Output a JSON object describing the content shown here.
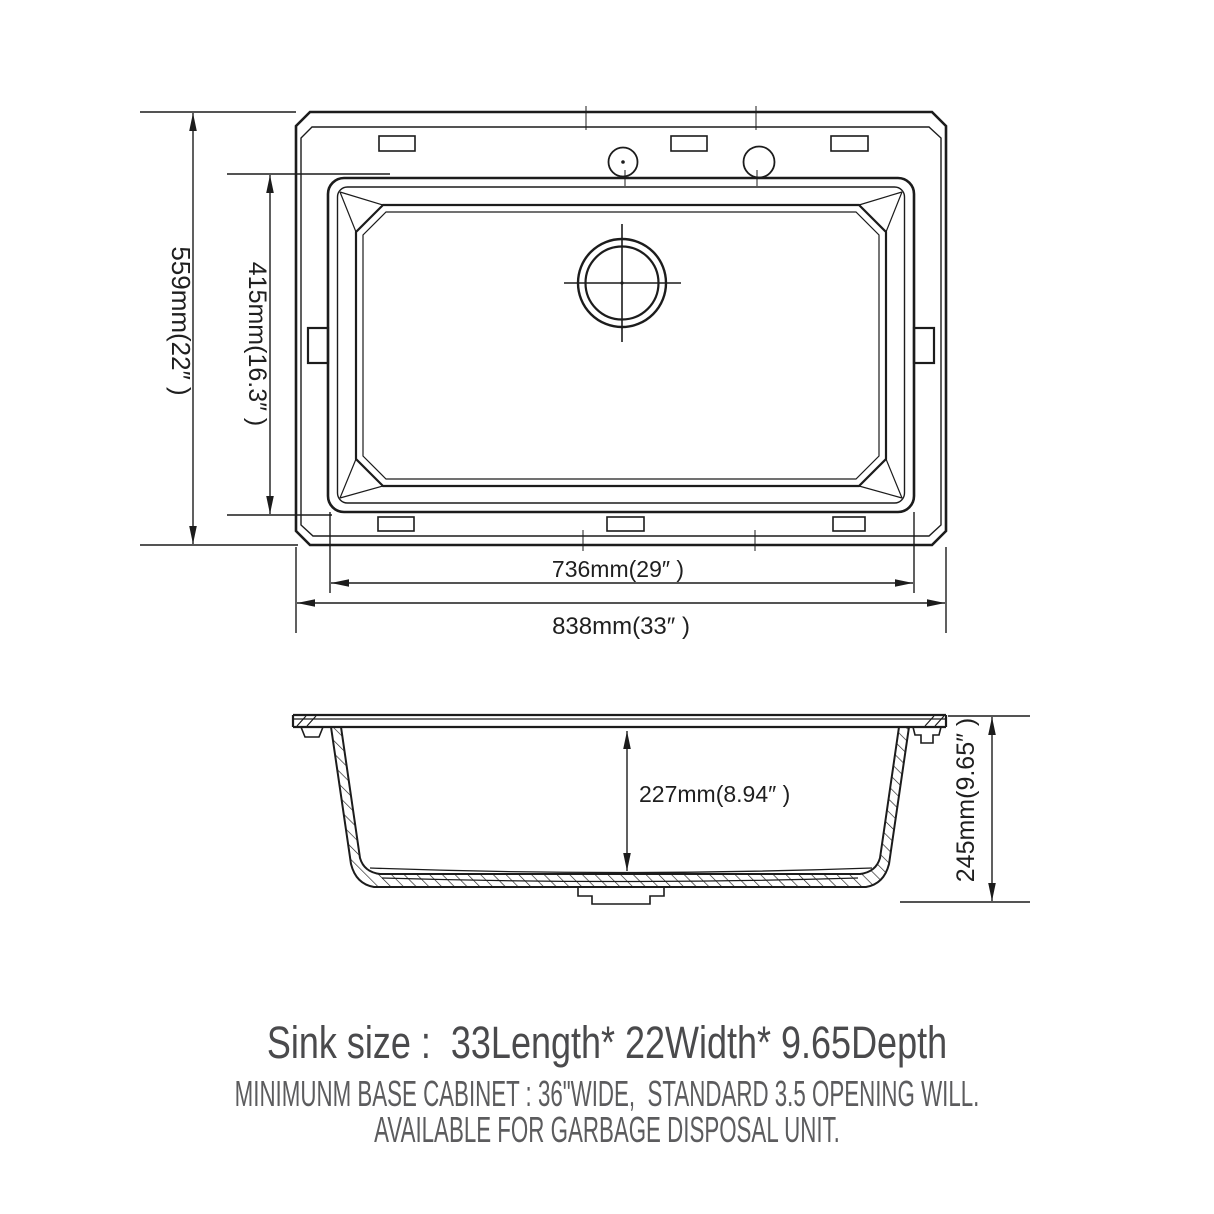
{
  "page": {
    "background": "#ffffff"
  },
  "colors": {
    "line": "#1c1c1c",
    "dimension_text": "#1f1f1f",
    "caption_primary": "#4a4a4c",
    "caption_secondary": "#5c5c5e"
  },
  "top_view": {
    "dim_overall_depth": "559mm(22″ )",
    "dim_basin_depth": "415mm(16.3″ )",
    "dim_basin_width": "736mm(29″ )",
    "dim_overall_width": "838mm(33″ )"
  },
  "side_view": {
    "dim_inner_depth": "227mm(8.94″ )",
    "dim_overall_height": "245mm(9.65″ )"
  },
  "caption": {
    "size_line": "Sink size :  33Length* 22Width* 9.65Depth",
    "note_line_1": "MINIMUNM BASE CABINET : 36\"WIDE,  STANDARD 3.5 OPENING WILL.",
    "note_line_2": "AVAILABLE FOR GARBAGE DISPOSAL UNIT."
  }
}
